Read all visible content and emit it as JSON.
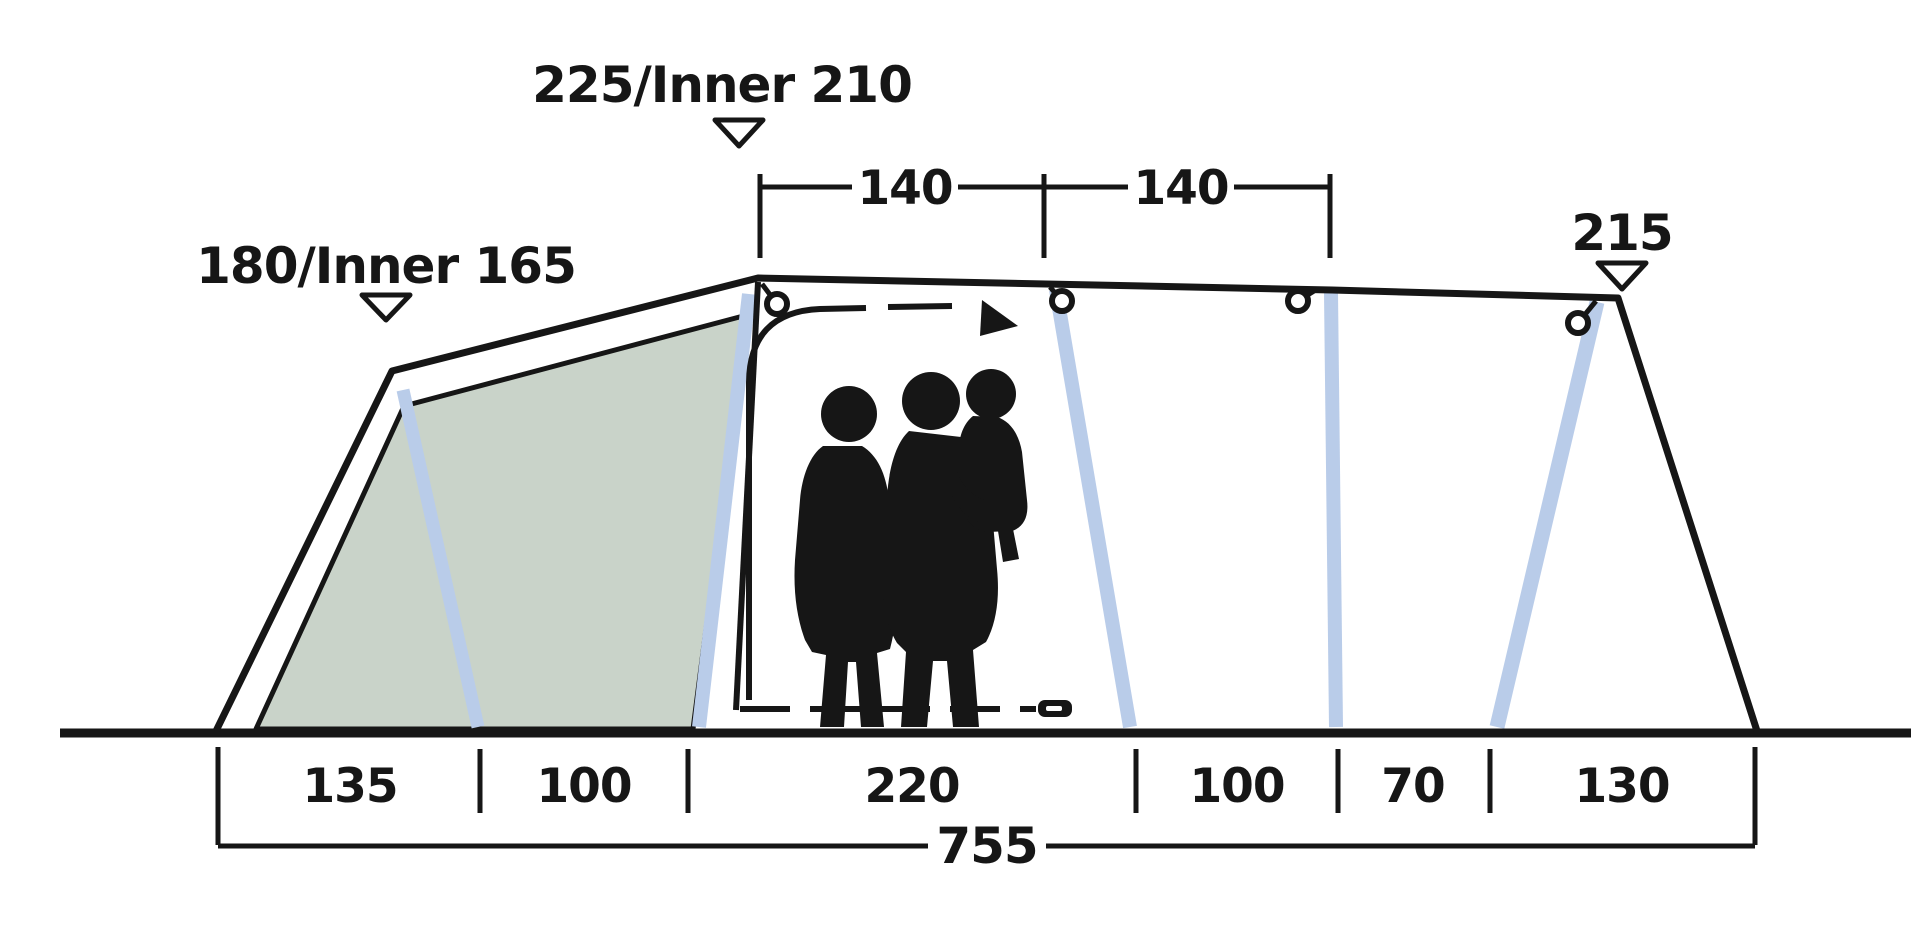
{
  "diagram": {
    "peak_height_label": "225/Inner 210",
    "left_height_label": "180/Inner 165",
    "right_height_label": "215",
    "roof_segment_labels": [
      "140",
      "140"
    ],
    "floor_segment_labels": [
      "135",
      "100",
      "220",
      "100",
      "70",
      "130"
    ],
    "total_length_label": "755",
    "colors": {
      "line": "#161616",
      "pole_blue": "#b9cce9",
      "inner_panel_green": "#c9d3c9",
      "background": "#ffffff"
    }
  }
}
